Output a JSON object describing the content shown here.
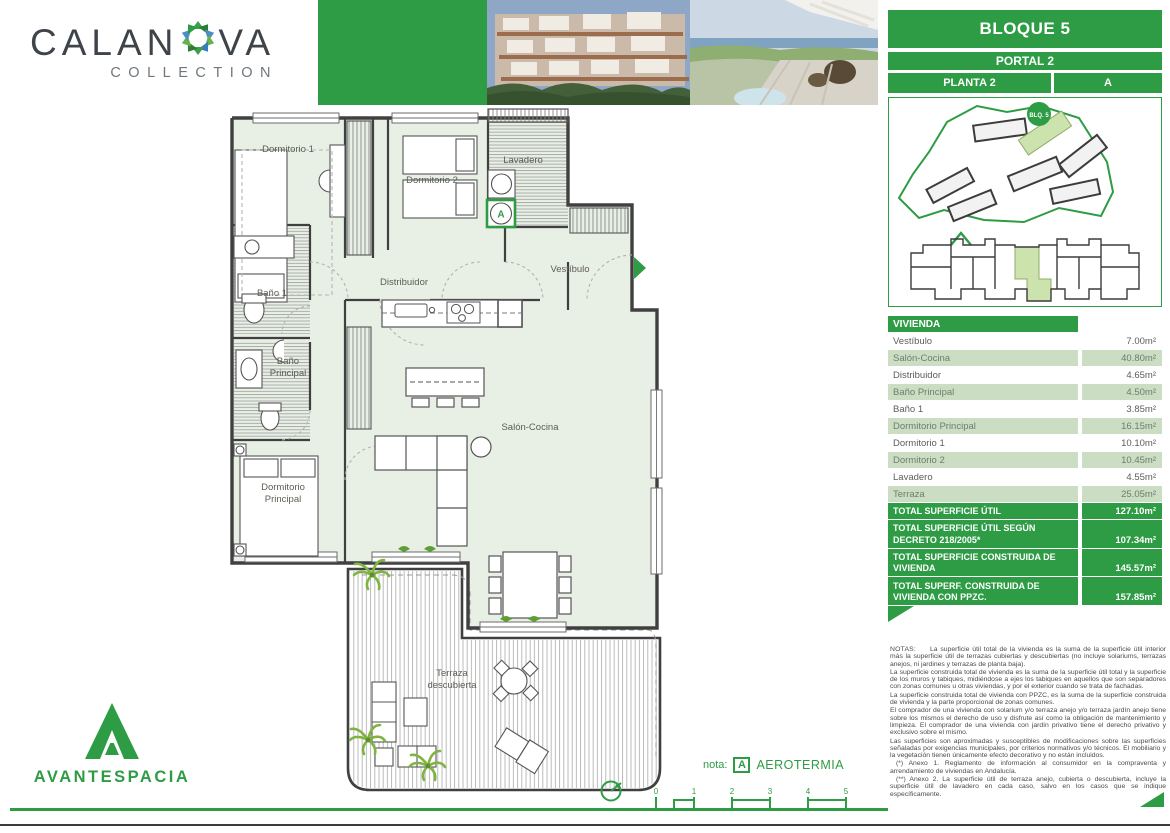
{
  "brand": {
    "calanova_word_left": "CALAN",
    "calanova_word_right": "VA",
    "calanova_subtitle": "COLLECTION",
    "avantespacia": "AVANTESPACIA"
  },
  "header": {
    "bloque": "BLOQUE 5",
    "portal": "PORTAL 2",
    "planta": "PLANTA 2",
    "letra": "A",
    "site_badge": "BLQ. 5"
  },
  "table": {
    "header": "VIVIENDA",
    "rows": [
      {
        "label": "Vestíbulo",
        "value": "7.00m²"
      },
      {
        "label": "Salón-Cocina",
        "value": "40.80m²"
      },
      {
        "label": "Distribuidor",
        "value": "4.65m²"
      },
      {
        "label": "Baño Principal",
        "value": "4.50m²"
      },
      {
        "label": "Baño 1",
        "value": "3.85m²"
      },
      {
        "label": "Dormitorio Principal",
        "value": "16.15m²"
      },
      {
        "label": "Dormitorio 1",
        "value": "10.10m²"
      },
      {
        "label": "Dormitorio 2",
        "value": "10.45m²"
      },
      {
        "label": "Lavadero",
        "value": "4.55m²"
      },
      {
        "label": "Terraza",
        "value": "25.05m²"
      }
    ],
    "totals": [
      {
        "label": "TOTAL SUPERFICIE ÚTIL",
        "value": "127.10m²"
      },
      {
        "label": "TOTAL SUPERFICIE ÚTIL SEGÚN DECRETO 218/2005*",
        "value": "107.34m²"
      },
      {
        "label": "TOTAL SUPERFICIE CONSTRUIDA DE VIVIENDA",
        "value": "145.57m²"
      },
      {
        "label": "TOTAL SUPERF. CONSTRUIDA DE VIVIENDA CON PPZC.",
        "value": "157.85m²"
      }
    ]
  },
  "plan": {
    "dormitorio1": "Dormitorio 1",
    "dormitorio2": "Dormitorio 2",
    "lavadero": "Lavadero",
    "vestibulo": "Vestíbulo",
    "distribuidor": "Distribuidor",
    "bano1": "Baño 1",
    "bano_principal_1": "Baño",
    "bano_principal_2": "Principal",
    "dorm_principal_1": "Dormitorio",
    "dorm_principal_2": "Principal",
    "salon": "Salón-Cocina",
    "terraza_1": "Terraza",
    "terraza_2": "descubierta",
    "marker": "A"
  },
  "footer": {
    "nota_label": "nota:",
    "nota_marker": "A",
    "nota_text": "AEROTERMIA",
    "scale_ticks": [
      "0",
      "1",
      "2",
      "3",
      "4",
      "5"
    ]
  },
  "notes": {
    "title": "NOTAS:",
    "paragraphs": [
      "La superficie útil total de la vivienda es la suma de la superficie útil interior más la superficie útil de terrazas cubiertas y descubiertas (no incluye solariums, terrazas anejos, ni jardines y terrazas de planta baja).",
      "La superficie construida total de vivienda es la suma de la superficie útil total y la superficie de los muros y tabiques, midiéndose a ejes los tabiques en aquellos que son separadores con zonas comunes u otras viviendas, y por el exterior cuando se trata de fachadas.",
      "La superficie construida total de vivienda con PPZC, es la suma de la superficie construida de vivienda y la parte proporcional de zonas comunes.",
      "El comprador de una vivienda con solarium y/o terraza anejo y/o terraza jardín anejo tiene sobre los mismos el derecho de uso y disfrute así como la obligación de mantenimiento y limpieza. El comprador de una vivienda con jardín privativo tiene el derecho privativo y exclusivo sobre el mismo.",
      "Las superficies son aproximadas y susceptibles de modificaciones sobre las superficies señaladas por exigencias municipales, por criterios normativos y/o técnicos. El mobiliario y la vegetación tienen únicamente efecto decorativo y no están incluidos.",
      "(*) Anexo 1. Reglamento de información al consumidor en la compraventa y arrendamiento de viviendas en Andalucía.",
      "(**) Anexo 2. La superficie útil de terraza anejo, cubierta o descubierta, incluye la superficie útil de lavadero en cada caso, salvo en los casos que se indique específicamente."
    ]
  },
  "colors": {
    "accent_green": "#2e9c45",
    "row_green": "#cbddc3",
    "plan_fill": "#e8efe4",
    "wall": "#404040"
  }
}
